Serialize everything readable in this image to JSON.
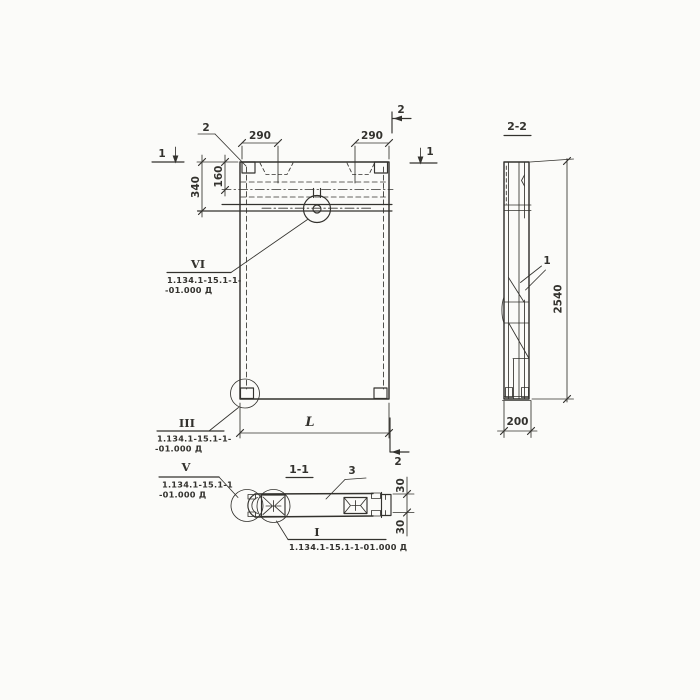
{
  "front_view": {
    "dims": {
      "d290_left": "290",
      "d290_right": "290",
      "d340": "340",
      "d160": "160",
      "length": "L"
    },
    "marks": {
      "sec1_left": "1",
      "sec1_right": "1",
      "sec2_top": "2",
      "sec2_bottom": "2",
      "callout_2": "2"
    },
    "details": {
      "vi": {
        "label": "VI",
        "doc1": "1.134.1-15.1-1-",
        "doc2": "-01.000 Д"
      },
      "iii": {
        "label": "III",
        "doc1": "1.134.1-15.1-1-",
        "doc2": "-01.000 Д"
      }
    }
  },
  "section_1_1": {
    "title": "1-1",
    "dims": {
      "d30_top": "30",
      "d30_bottom": "30"
    },
    "marks": {
      "callout_3": "3"
    },
    "details": {
      "v": {
        "label": "V",
        "doc1": "1.134.1-15.1-1",
        "doc2": "-01.000 Д"
      },
      "i": {
        "label": "I",
        "doc": "1.134.1-15.1-1-01.000 Д"
      }
    }
  },
  "section_2_2": {
    "title": "2-2",
    "dims": {
      "d2540": "2540",
      "d200": "200"
    },
    "marks": {
      "callout_1": "1"
    }
  },
  "colors": {
    "ink": "#33322e",
    "paper": "#fbfbf9"
  }
}
